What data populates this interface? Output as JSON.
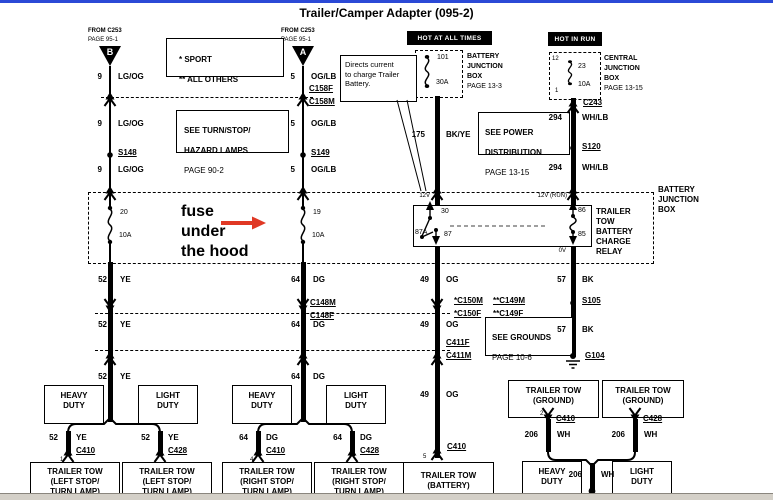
{
  "window": {
    "title": "Trailer/Camper Adapter (095-2)"
  },
  "annotation": {
    "fuse_note": "fuse\nunder\nthe hood"
  },
  "legend": {
    "sport": "* SPORT",
    "all_others": "** ALL OTHERS"
  },
  "callout": {
    "text": "Directs current\nto charge Trailer\nBattery."
  },
  "banners": {
    "hot_at_all_times": "HOT AT ALL TIMES",
    "hot_in_run": "HOT IN RUN"
  },
  "sources": {
    "from_c253": "FROM C253",
    "page_95_1": "PAGE 95-1",
    "conn_b": "B",
    "conn_a": "A"
  },
  "ref_boxes": {
    "turn_stop": {
      "l1": "SEE TURN/STOP/",
      "l2": "HAZARD LAMPS",
      "page": "PAGE 90-2"
    },
    "power_dist": {
      "l1": "SEE POWER",
      "l2": "DISTRIBUTION",
      "page": "PAGE 13-15"
    },
    "grounds": {
      "l1": "SEE GROUNDS",
      "page": "PAGE 10-6"
    }
  },
  "bjb_fuse": {
    "l1": "BATTERY",
    "l2": "JUNCTION",
    "l3": "BOX",
    "page": "PAGE 13-3",
    "id": "101",
    "amp": "30A"
  },
  "cjb": {
    "l1": "CENTRAL",
    "l2": "JUNCTION",
    "l3": "BOX",
    "page": "PAGE 13-15",
    "pin_top": "12",
    "pin_bottom": "1",
    "id": "23",
    "amp": "10A"
  },
  "bjb": {
    "label": "BATTERY\nJUNCTION\nBOX",
    "fuse20_id": "20",
    "fuse20_amp": "10A",
    "fuse19_id": "19",
    "fuse19_amp": "10A"
  },
  "relay": {
    "label": "TRAILER\nTOW\nBATTERY\nCHARGE\nRELAY",
    "p30": "30",
    "p87a": "87A",
    "p87": "87",
    "p86": "86",
    "p85": "85",
    "v12": "12V",
    "v12run": "12V (RUN)",
    "v0": "0V"
  },
  "circuits": {
    "c9": {
      "num": "9",
      "color": "LG/OG"
    },
    "c5": {
      "num": "5",
      "color": "OG/LB"
    },
    "c175": {
      "num": "175",
      "color": "BK/YE"
    },
    "c294": {
      "num": "294",
      "color": "WH/LB"
    },
    "c52": {
      "num": "52",
      "color": "YE"
    },
    "c64": {
      "num": "64",
      "color": "DG"
    },
    "c49": {
      "num": "49",
      "color": "OG"
    },
    "c57": {
      "num": "57",
      "color": "BK"
    },
    "c206": {
      "num": "206",
      "color": "WH"
    }
  },
  "connectors": {
    "c158f": "C158F",
    "c158m": "C158M",
    "c148m": "C148M",
    "c148f": "C148F",
    "c150m": "*C150M",
    "c150f": "*C150F",
    "c149m": "**C149M",
    "c149f": "**C149F",
    "c411f": "C411F",
    "c411m": "C411M",
    "c243": "C243",
    "c410": "C410",
    "c428": "C428"
  },
  "splices": {
    "s148": "S148",
    "s149": "S149",
    "s120": "S120",
    "s105": "S105"
  },
  "grounds": {
    "g104": "G104"
  },
  "pins": {
    "p1": "1",
    "p2": "2",
    "p4": "4",
    "p5": "5"
  },
  "duty": {
    "heavy": "HEAVY\nDUTY",
    "light": "LIGHT\nDUTY"
  },
  "loads": {
    "left_stop": "TRAILER TOW\n(LEFT STOP/\nTURN LAMP)",
    "right_stop": "TRAILER TOW\n(RIGHT STOP/\nTURN LAMP)",
    "battery": "TRAILER TOW\n(BATTERY)",
    "ground": "TRAILER TOW\n(GROUND)"
  }
}
